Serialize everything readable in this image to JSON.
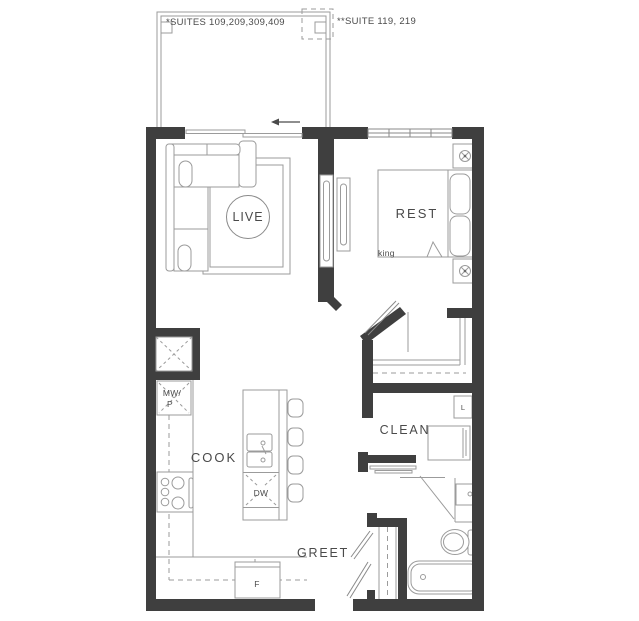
{
  "plan": {
    "suites_label": "*SUITES 109,209,309,409",
    "suite2_label": "**SUITE 119, 219",
    "rooms": {
      "live": "LIVE",
      "rest": "REST",
      "cook": "COOK",
      "clean": "CLEAN",
      "greet": "GREET"
    },
    "fixtures": {
      "bed_size": "king",
      "microwave_line1": "MW/",
      "microwave_line2": "P",
      "dishwasher": "DW",
      "fridge": "F",
      "linen": "L"
    },
    "colors": {
      "wall": "#3f3f3f",
      "furniture_line": "#9b9b9b",
      "furniture_line_dark": "#8a8a8a",
      "text": "#4a4a4a",
      "background": "#ffffff"
    }
  }
}
